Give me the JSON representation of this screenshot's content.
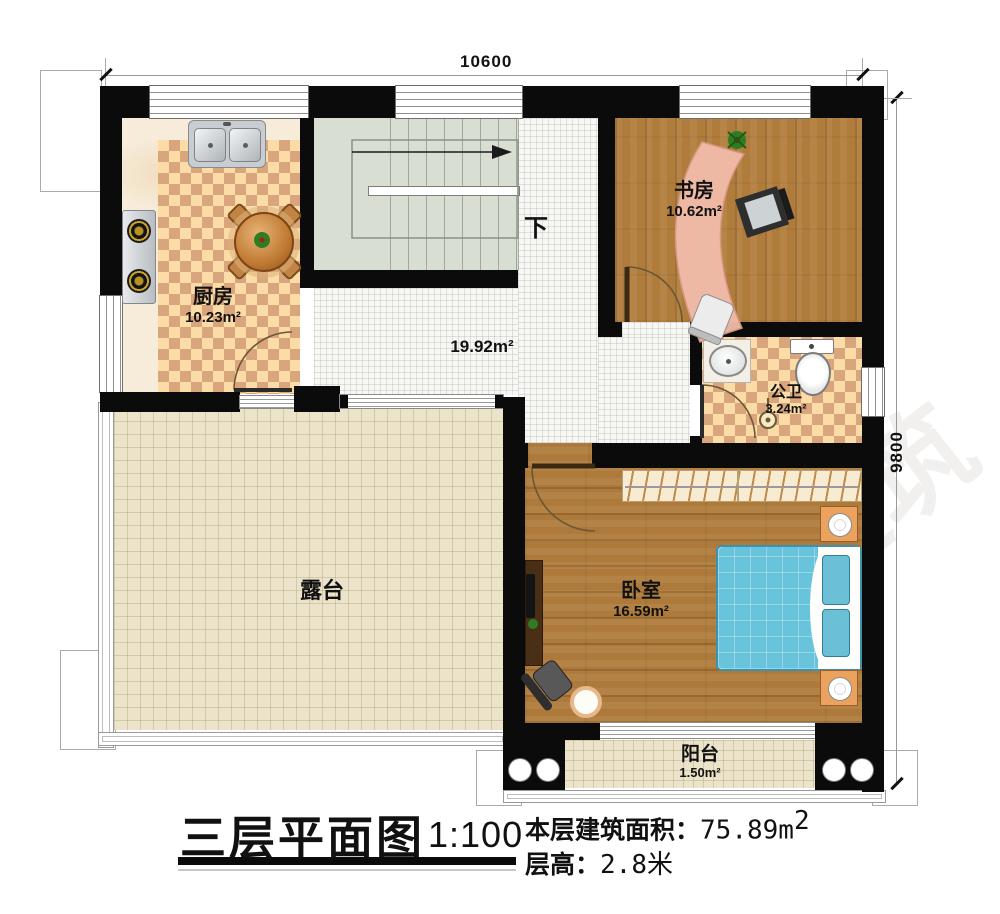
{
  "dimensions": {
    "top": "10600",
    "right": "9800"
  },
  "rooms": {
    "kitchen": {
      "name": "厨房",
      "area": "10.23m²"
    },
    "study": {
      "name": "书房",
      "area": "10.62m²"
    },
    "bathroom": {
      "name": "公卫",
      "area": "3.24m²"
    },
    "bedroom": {
      "name": "卧室",
      "area": "16.59m²"
    },
    "terrace": {
      "name": "露台"
    },
    "balcony": {
      "name": "阳台",
      "area": "1.50m²"
    },
    "hall": {
      "area": "19.92m²"
    }
  },
  "stairs": {
    "direction_label": "下"
  },
  "title_block": {
    "title": "三层平面图",
    "scale": "1:100",
    "area_label": "本层建筑面积：",
    "area_value": "75.89",
    "area_unit": "m",
    "area_superscript": "2",
    "floor_height_label": "层高：",
    "floor_height_value": "2.8米"
  },
  "watermark": {
    "brand": "柏竣建筑",
    "url": "www.bqjunzhu.com"
  },
  "colors": {
    "wall": "#0b0b0b",
    "wood": "#b07c3c",
    "bed_blue": "#68c4db",
    "checker_light": "#fbdca6",
    "checker_dark": "#d8a57c",
    "terrace": "#ece4ca",
    "stair": "#d9ded2",
    "desk_salmon": "#f2bcaa",
    "nightstand_orange": "#e9a35f"
  }
}
